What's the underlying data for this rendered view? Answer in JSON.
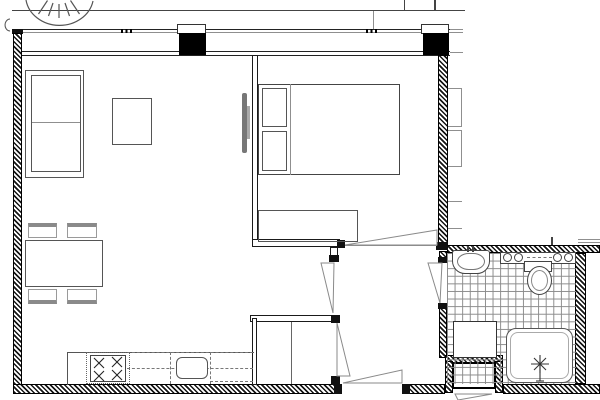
{
  "document": {
    "type": "architectural-floor-plan",
    "title": "One-bedroom apartment floor plan",
    "text_visible": "none"
  },
  "palette": {
    "background": "#ffffff",
    "wall_line": "#000000",
    "column_fill": "#000000",
    "hatch_fill": "#151515",
    "furniture_line": "#666666",
    "light_line": "#8f8f8f",
    "tile_line": "#8a8a8a"
  },
  "rooms": [
    {
      "name": "living-dining-kitchen",
      "furniture": [
        "sofa",
        "coffee-table",
        "wall-mounted-tv",
        "dining-table",
        "chair x4",
        "kitchen-counter",
        "stove-4-burners",
        "kitchen-sink",
        "overhead-cabinets-dashed"
      ]
    },
    {
      "name": "bedroom",
      "furniture": [
        "double-bed",
        "pillow x2",
        "dresser"
      ],
      "door": "hinged, swings into bedroom"
    },
    {
      "name": "hallway",
      "doors": [
        "entry-door",
        "living-room-door",
        "closet-door",
        "bathroom-door"
      ]
    },
    {
      "name": "closet",
      "features": [
        "center-divider-shelf"
      ]
    },
    {
      "name": "bathroom",
      "fixtures": [
        "washbasin-with-tap",
        "vanity-shelf-4-knobs",
        "toilet",
        "washing-machine",
        "shower-tray",
        "shower-drain-symbol",
        "floor-tile-grid"
      ]
    }
  ],
  "exterior": {
    "features": [
      "glazed-window-band-top",
      "structural-column x2",
      "hatched-exterior-walls",
      "balcony-edge-line",
      "compass-arc-symbol",
      "service-niche-with-outward-door",
      "facade-bracket x2"
    ]
  }
}
